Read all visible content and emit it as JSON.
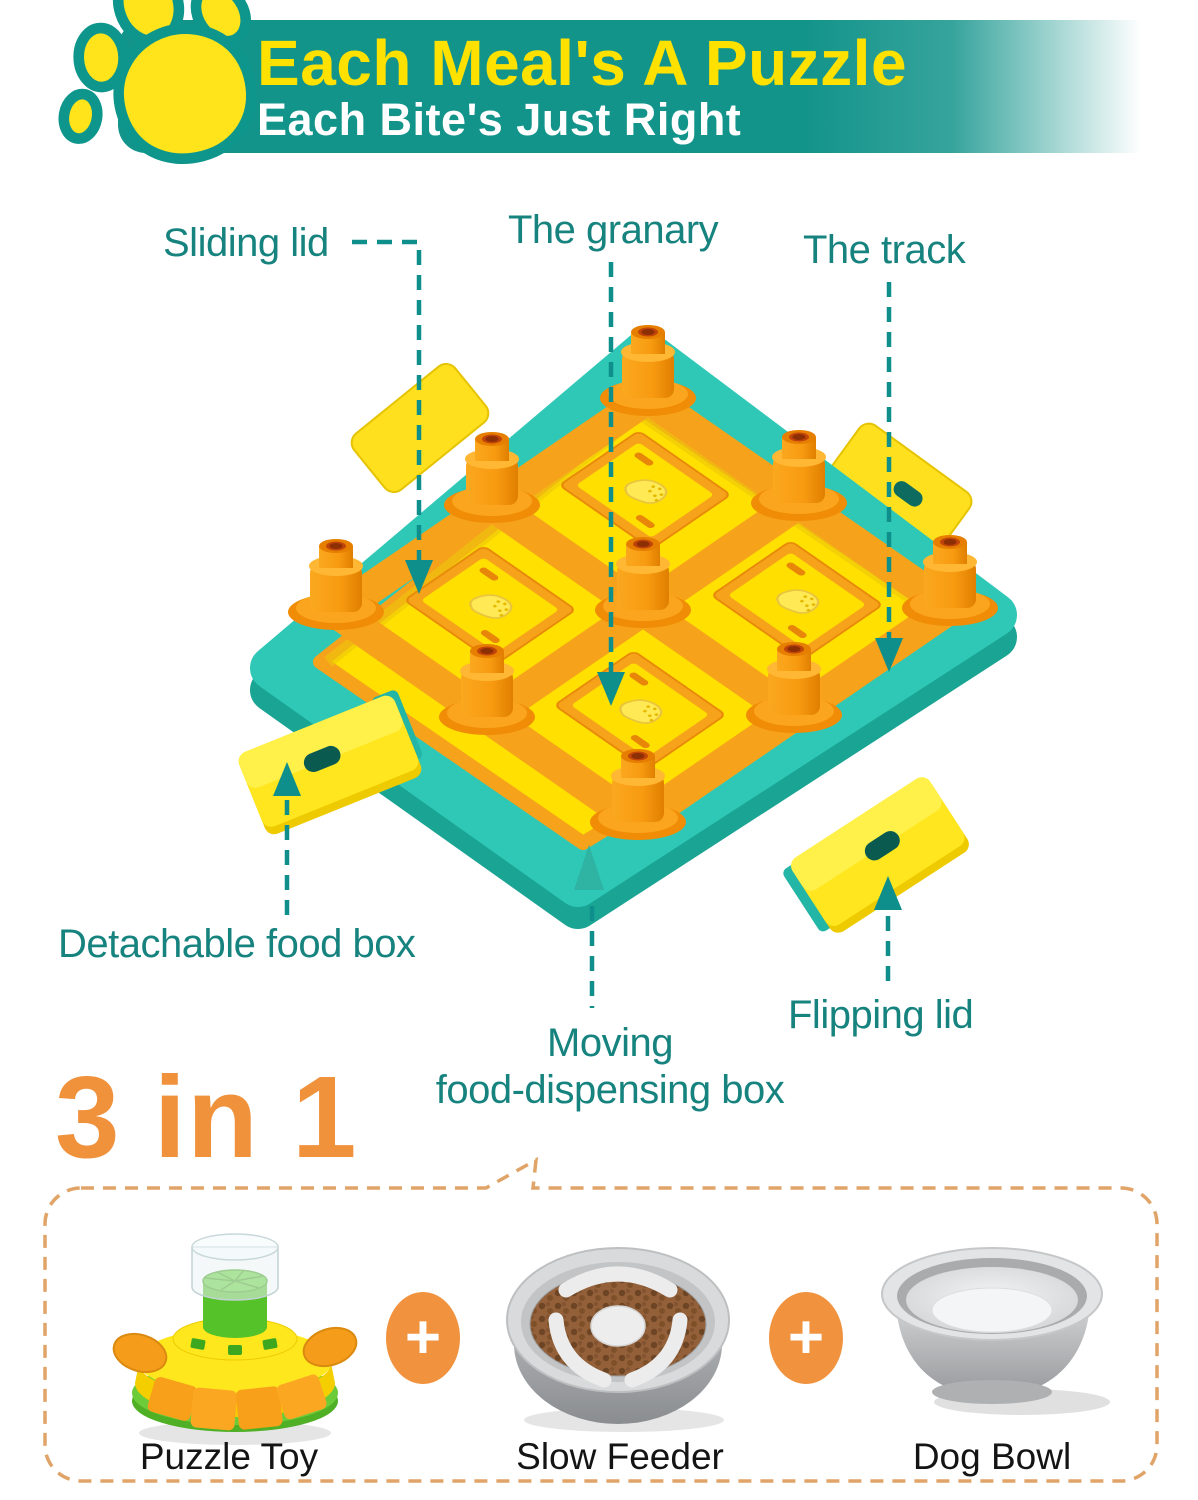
{
  "header": {
    "title": "Each Meal's A Puzzle",
    "subtitle": "Each Bite's Just Right",
    "banner_color": "#13948B",
    "title_color": "#FFE100",
    "subtitle_color": "#FFFFFF"
  },
  "icons": {
    "paw": "paw-print",
    "plus": "+",
    "annotation_arrow": "teal-dashed-arrow"
  },
  "annotations": {
    "label_color": "#17837F",
    "sliding_lid": "Sliding lid",
    "granary": "The granary",
    "track": "The track",
    "detachable_food_box": "Detachable food box",
    "moving_line1": "Moving",
    "moving_line2": "food-dispensing box",
    "flipping_lid": "Flipping lid"
  },
  "product": {
    "body_color": "#2FC8B6",
    "surface_color": "#FFE000",
    "accent_color": "#F6A21B"
  },
  "combo": {
    "headline": "3 in 1",
    "headline_color": "#F0913C",
    "border_color": "#E0A468",
    "plus": "+",
    "items": [
      {
        "label": "Puzzle Toy"
      },
      {
        "label": "Slow Feeder"
      },
      {
        "label": "Dog Bowl"
      }
    ]
  }
}
